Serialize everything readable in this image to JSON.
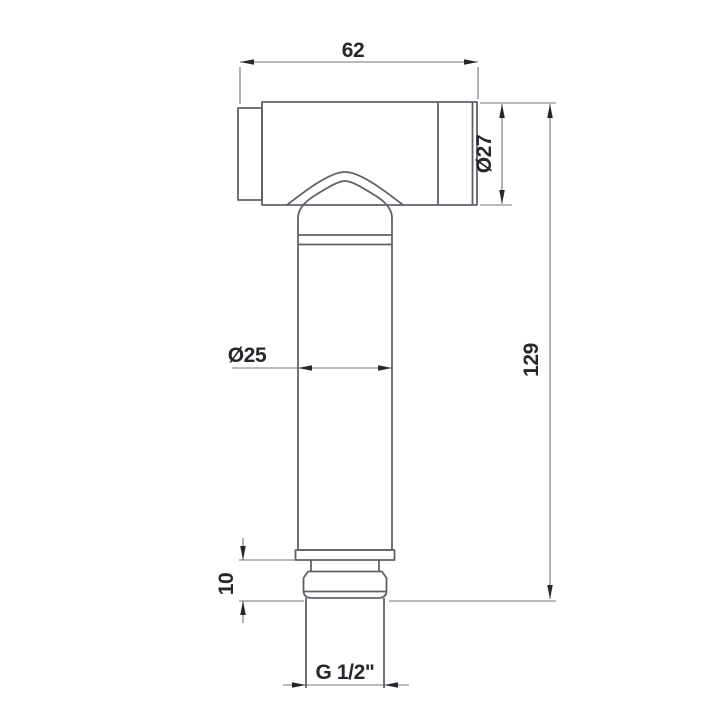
{
  "drawing": {
    "kind": "technical-dimension-drawing",
    "part": "hand-held sprayer side view",
    "dimensions": {
      "head_width": "62",
      "head_diameter": "Ø27",
      "handle_diameter": "Ø25",
      "overall_height": "129",
      "connector_exposed_height": "10",
      "thread_size": "G 1/2\""
    },
    "colors": {
      "background": "#ffffff",
      "outline": "#60606a",
      "dimension_line": "#73737d",
      "annotation": "#26262c"
    }
  }
}
